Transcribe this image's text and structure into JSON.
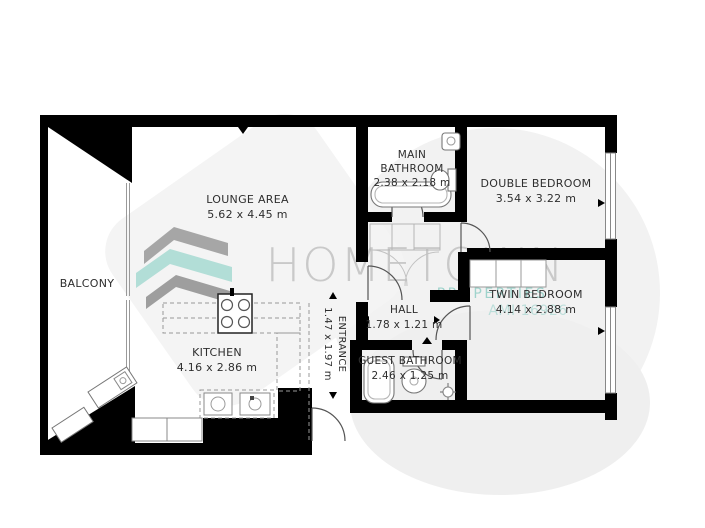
{
  "colors": {
    "wall": "#000000",
    "fixture_stroke": "#777777",
    "watermark_gray": "#c9c9c9",
    "watermark_teal": "#9fd3cc",
    "logo_gray": "#a6a6a6",
    "logo_teal": "#b2ded7"
  },
  "watermark": {
    "brand": "HOMETOWN",
    "tagline": "PROPERTIES",
    "license": "AMI 16926"
  },
  "rooms": {
    "balcony": {
      "name": "BALCONY"
    },
    "lounge": {
      "name": "LOUNGE AREA",
      "dims": "5.62 x 4.45 m"
    },
    "kitchen": {
      "name": "KITCHEN",
      "dims": "4.16 x 2.86 m"
    },
    "main_bathroom": {
      "name_line1": "MAIN",
      "name_line2": "BATHROOM",
      "dims": "2.38 x 2.18 m"
    },
    "double_bedroom": {
      "name": "DOUBLE BEDROOM",
      "dims": "3.54 x 3.22 m"
    },
    "hall": {
      "name": "HALL",
      "dims": "1.78 x 1.21 m"
    },
    "entrance": {
      "name": "ENTRANCE",
      "dims": "1.47 x 1.97 m"
    },
    "guest_bathroom": {
      "name": "GUEST BATHROOM",
      "dims": "2.46 x 1.25 m"
    },
    "twin_bedroom": {
      "name": "TWIN BEDROOM",
      "dims": "4.14 x 2.88 m"
    }
  }
}
